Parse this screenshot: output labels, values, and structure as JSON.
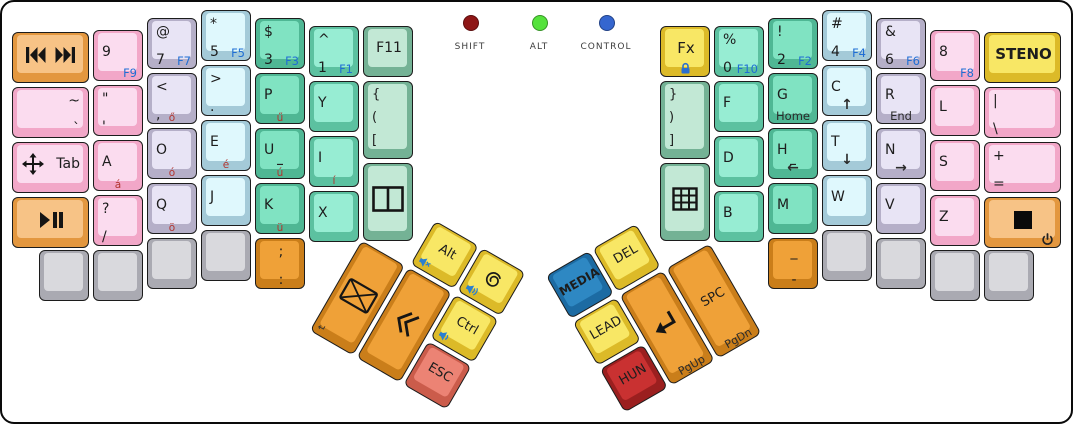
{
  "board": {
    "width": 1073,
    "height": 424
  },
  "indicators": {
    "shift": {
      "label": "SHIFT",
      "color": "#8e1616",
      "x": 468
    },
    "alt": {
      "label": "ALT",
      "color": "#55e23c",
      "x": 537
    },
    "control": {
      "label": "CONTROL",
      "color": "#3566cf",
      "x": 604
    }
  },
  "palette": {
    "fn_label": "#1f6ed4",
    "accent_label": "#b23530",
    "pink": "#fbdcef",
    "lavender": "#e8e4f5",
    "cyan": "#dff8fd",
    "teal": "#80e3c2",
    "teal_light": "#97edd3",
    "green_pale": "#c2e8d5",
    "yellow": "#f8e765",
    "orange_light": "#f7c386",
    "orange_strong": "#efa138",
    "blue": "#2e88c3",
    "red": "#c93131",
    "salmon": "#ec8374",
    "gray": "#d9d9dd"
  },
  "groups": [
    {
      "name": "left-hand",
      "x": 0,
      "y": 0,
      "rot": 0,
      "keys": [
        {
          "id": "key-media-prev-next",
          "x": 10,
          "y": 30,
          "w": 77,
          "color": "orange",
          "icons": [
            {
              "glyph": "prev",
              "name": "media-previous-icon"
            },
            {
              "glyph": "next",
              "name": "media-next-icon"
            }
          ]
        },
        {
          "id": "key-9",
          "x": 91,
          "y": 28,
          "color": "pink",
          "lines": [
            "9"
          ],
          "fn": "F9"
        },
        {
          "id": "key-7",
          "x": 145,
          "y": 16,
          "color": "lav",
          "lines": [
            "@",
            "7"
          ],
          "fn": "F7"
        },
        {
          "id": "key-5",
          "x": 199,
          "y": 8,
          "color": "cyan",
          "lines": [
            "*",
            "5"
          ],
          "fn": "F5"
        },
        {
          "id": "key-3",
          "x": 253,
          "y": 16,
          "color": "teal",
          "lines": [
            "$",
            "3"
          ],
          "fn": "F3"
        },
        {
          "id": "key-1",
          "x": 307,
          "y": 24,
          "color": "teal2",
          "lines": [
            "^",
            "1"
          ],
          "fn": "F1"
        },
        {
          "id": "key-f11",
          "x": 361,
          "y": 24,
          "color": "green",
          "lines": [
            "F11"
          ],
          "align": "center"
        },
        {
          "id": "key-tilde",
          "x": 10,
          "y": 85,
          "w": 77,
          "color": "pink",
          "lines": [
            "~",
            "`"
          ],
          "align": "right"
        },
        {
          "id": "key-quote",
          "x": 91,
          "y": 83,
          "color": "pink",
          "lines": [
            "\"",
            "'"
          ]
        },
        {
          "id": "key-comma",
          "x": 145,
          "y": 71,
          "color": "lav",
          "lines": [
            "<",
            ","
          ],
          "accent": "ő"
        },
        {
          "id": "key-period",
          "x": 199,
          "y": 63,
          "color": "cyan",
          "lines": [
            ">",
            "."
          ]
        },
        {
          "id": "key-p",
          "x": 253,
          "y": 71,
          "color": "teal",
          "lines": [
            "P"
          ],
          "accent": "ű"
        },
        {
          "id": "key-y",
          "x": 307,
          "y": 79,
          "color": "teal2",
          "lines": [
            "Y"
          ]
        },
        {
          "id": "key-brackets-open",
          "x": 361,
          "y": 79,
          "h": 78,
          "color": "green",
          "lines": [
            "{",
            "(",
            "["
          ]
        },
        {
          "id": "key-tab",
          "x": 10,
          "y": 140,
          "w": 77,
          "color": "pink",
          "lines": [
            "Tab"
          ],
          "align": "right",
          "icons": [
            {
              "glyph": "move",
              "name": "move-icon",
              "pos": "l"
            }
          ]
        },
        {
          "id": "key-a",
          "x": 91,
          "y": 138,
          "color": "pink",
          "lines": [
            "A"
          ],
          "accent": "á"
        },
        {
          "id": "key-o",
          "x": 145,
          "y": 126,
          "color": "lav",
          "lines": [
            "O"
          ],
          "accent": "ó"
        },
        {
          "id": "key-e",
          "x": 199,
          "y": 118,
          "color": "cyan",
          "lines": [
            "E"
          ],
          "accent": "é"
        },
        {
          "id": "key-u",
          "x": 253,
          "y": 126,
          "color": "teal",
          "lines": [
            "U"
          ],
          "homing": "_",
          "accent": "ú"
        },
        {
          "id": "key-i",
          "x": 307,
          "y": 134,
          "color": "teal2",
          "lines": [
            "I"
          ],
          "accent": "í"
        },
        {
          "id": "key-window-split",
          "x": 361,
          "y": 161,
          "h": 78,
          "color": "green",
          "icons": [
            {
              "glyph": "winsplit",
              "name": "window-split-icon"
            }
          ]
        },
        {
          "id": "key-play-pause",
          "x": 10,
          "y": 195,
          "w": 77,
          "color": "orange",
          "icons": [
            {
              "glyph": "playpause",
              "name": "play-pause-icon"
            }
          ]
        },
        {
          "id": "key-question",
          "x": 91,
          "y": 193,
          "color": "pink",
          "lines": [
            "?",
            "/"
          ]
        },
        {
          "id": "key-q",
          "x": 145,
          "y": 181,
          "color": "lav",
          "lines": [
            "Q"
          ],
          "accent": "ö"
        },
        {
          "id": "key-j",
          "x": 199,
          "y": 173,
          "color": "cyan",
          "lines": [
            "J"
          ]
        },
        {
          "id": "key-k",
          "x": 253,
          "y": 181,
          "color": "teal",
          "lines": [
            "K"
          ],
          "accent": "ü"
        },
        {
          "id": "key-x",
          "x": 307,
          "y": 189,
          "color": "teal2",
          "lines": [
            "X"
          ]
        },
        {
          "id": "key-blank-left-1",
          "x": 37,
          "y": 248,
          "color": "gray"
        },
        {
          "id": "key-blank-left-2",
          "x": 91,
          "y": 248,
          "color": "gray"
        },
        {
          "id": "key-blank-left-3",
          "x": 145,
          "y": 236,
          "color": "gray"
        },
        {
          "id": "key-blank-left-4",
          "x": 199,
          "y": 228,
          "color": "gray"
        },
        {
          "id": "key-semicolon",
          "x": 253,
          "y": 236,
          "color": "orange2",
          "lines": [
            ";",
            ":"
          ],
          "align": "center"
        }
      ]
    },
    {
      "name": "right-hand",
      "x": 0,
      "y": 0,
      "rot": 0,
      "keys": [
        {
          "id": "key-fx",
          "x": 658,
          "y": 24,
          "color": "yellow",
          "lines": [
            "Fx"
          ],
          "align": "center",
          "icons": [
            {
              "glyph": "lock",
              "name": "lock-icon",
              "pos": "bc"
            }
          ]
        },
        {
          "id": "key-0",
          "x": 712,
          "y": 24,
          "color": "teal2",
          "lines": [
            "%",
            "0"
          ],
          "fn": "F10"
        },
        {
          "id": "key-2",
          "x": 766,
          "y": 16,
          "color": "teal",
          "lines": [
            "!",
            "2"
          ],
          "fn": "F2"
        },
        {
          "id": "key-4",
          "x": 820,
          "y": 8,
          "color": "cyan",
          "lines": [
            "#",
            "4"
          ],
          "fn": "F4"
        },
        {
          "id": "key-6",
          "x": 874,
          "y": 16,
          "color": "lav",
          "lines": [
            "&",
            "6"
          ],
          "fn": "F6"
        },
        {
          "id": "key-8",
          "x": 928,
          "y": 28,
          "color": "pink",
          "lines": [
            "8"
          ],
          "fn": "F8"
        },
        {
          "id": "key-steno",
          "x": 982,
          "y": 30,
          "w": 77,
          "color": "yellow",
          "lines": [
            "STENO"
          ],
          "align": "center"
        },
        {
          "id": "key-brackets-close",
          "x": 658,
          "y": 79,
          "h": 78,
          "color": "green",
          "lines": [
            "}",
            ")",
            "]"
          ]
        },
        {
          "id": "key-f",
          "x": 712,
          "y": 79,
          "color": "teal2",
          "lines": [
            "F"
          ]
        },
        {
          "id": "key-g",
          "x": 766,
          "y": 71,
          "color": "teal",
          "lines": [
            "G"
          ],
          "bottom": "Home"
        },
        {
          "id": "key-c",
          "x": 820,
          "y": 63,
          "color": "cyan",
          "lines": [
            "C"
          ],
          "bottom": "↑"
        },
        {
          "id": "key-r",
          "x": 874,
          "y": 71,
          "color": "lav",
          "lines": [
            "R"
          ],
          "bottom": "End"
        },
        {
          "id": "key-l",
          "x": 928,
          "y": 83,
          "color": "pink",
          "lines": [
            "L"
          ]
        },
        {
          "id": "key-pipe",
          "x": 982,
          "y": 85,
          "w": 77,
          "color": "pink",
          "lines": [
            "|",
            "\\"
          ]
        },
        {
          "id": "key-grid",
          "x": 658,
          "y": 161,
          "h": 78,
          "color": "green",
          "icons": [
            {
              "glyph": "grid",
              "name": "grid-icon"
            }
          ]
        },
        {
          "id": "key-d",
          "x": 712,
          "y": 134,
          "color": "teal2",
          "lines": [
            "D"
          ]
        },
        {
          "id": "key-h",
          "x": 766,
          "y": 126,
          "color": "teal",
          "lines": [
            "H"
          ],
          "homing": "_",
          "bottom": "←"
        },
        {
          "id": "key-t",
          "x": 820,
          "y": 118,
          "color": "cyan",
          "lines": [
            "T"
          ],
          "bottom": "↓"
        },
        {
          "id": "key-n",
          "x": 874,
          "y": 126,
          "color": "lav",
          "lines": [
            "N"
          ],
          "bottom": "→"
        },
        {
          "id": "key-s",
          "x": 928,
          "y": 138,
          "color": "pink",
          "lines": [
            "S"
          ]
        },
        {
          "id": "key-plus",
          "x": 982,
          "y": 140,
          "w": 77,
          "color": "pink",
          "lines": [
            "+",
            "="
          ]
        },
        {
          "id": "key-b",
          "x": 712,
          "y": 189,
          "color": "teal2",
          "lines": [
            "B"
          ]
        },
        {
          "id": "key-m",
          "x": 766,
          "y": 181,
          "color": "teal",
          "lines": [
            "M"
          ]
        },
        {
          "id": "key-w",
          "x": 820,
          "y": 173,
          "color": "cyan",
          "lines": [
            "W"
          ]
        },
        {
          "id": "key-v",
          "x": 874,
          "y": 181,
          "color": "lav",
          "lines": [
            "V"
          ]
        },
        {
          "id": "key-z",
          "x": 928,
          "y": 193,
          "color": "pink",
          "lines": [
            "Z"
          ]
        },
        {
          "id": "key-stop-power",
          "x": 982,
          "y": 195,
          "w": 77,
          "color": "orange",
          "icons": [
            {
              "glyph": "stop",
              "name": "stop-icon"
            },
            {
              "glyph": "power",
              "name": "power-icon",
              "pos": "br"
            }
          ]
        },
        {
          "id": "key-minus",
          "x": 766,
          "y": 236,
          "color": "orange2",
          "lines": [
            "_",
            "-"
          ],
          "align": "center"
        },
        {
          "id": "key-blank-right-1",
          "x": 820,
          "y": 228,
          "color": "gray"
        },
        {
          "id": "key-blank-right-2",
          "x": 874,
          "y": 236,
          "color": "gray"
        },
        {
          "id": "key-blank-right-3",
          "x": 928,
          "y": 248,
          "color": "gray"
        },
        {
          "id": "key-blank-right-4",
          "x": 982,
          "y": 248,
          "color": "gray"
        }
      ]
    },
    {
      "name": "left-thumb-cluster",
      "x": 386,
      "y": 189,
      "rot": 30,
      "keys": [
        {
          "id": "key-alt",
          "x": 56,
          "y": 2,
          "h": 50,
          "color": "yellow",
          "lines": [
            "Alt"
          ],
          "align": "center",
          "icons": [
            {
              "glyph": "volmute",
              "name": "volume-mute-icon",
              "pos": "bl"
            }
          ]
        },
        {
          "id": "key-debian",
          "x": 110,
          "y": 2,
          "h": 50,
          "color": "yellow",
          "icons": [
            {
              "glyph": "debian",
              "name": "debian-swirl-icon"
            },
            {
              "glyph": "volup",
              "name": "volume-up-icon",
              "pos": "bl"
            }
          ]
        },
        {
          "id": "key-mail",
          "x": 2,
          "y": 56,
          "h": 104,
          "color": "orange2",
          "corner": "↵",
          "icons": [
            {
              "glyph": "mail",
              "name": "mail-icon"
            }
          ]
        },
        {
          "id": "key-chevrons",
          "x": 56,
          "y": 56,
          "h": 104,
          "color": "orange2",
          "icons": [
            {
              "glyph": "chevleft",
              "name": "double-chevron-left-icon"
            }
          ]
        },
        {
          "id": "key-ctrl",
          "x": 110,
          "y": 56,
          "h": 50,
          "color": "yellow",
          "lines": [
            "Ctrl"
          ],
          "align": "center",
          "icons": [
            {
              "glyph": "voldown",
              "name": "volume-down-icon",
              "pos": "bl"
            }
          ]
        },
        {
          "id": "key-esc",
          "x": 110,
          "y": 110,
          "h": 50,
          "color": "salmon",
          "lines": [
            "ESC"
          ],
          "align": "center"
        }
      ]
    },
    {
      "name": "right-thumb-cluster",
      "x": 541,
      "y": 273,
      "rot": -30,
      "keys": [
        {
          "id": "key-media",
          "x": 2,
          "y": 2,
          "h": 50,
          "color": "blue",
          "lines": [
            "MEDIA"
          ],
          "align": "center"
        },
        {
          "id": "key-del",
          "x": 56,
          "y": 2,
          "h": 50,
          "color": "yellow",
          "lines": [
            "DEL"
          ],
          "align": "center"
        },
        {
          "id": "key-lead",
          "x": 2,
          "y": 56,
          "h": 50,
          "color": "yellow",
          "lines": [
            "LEAD"
          ],
          "align": "center"
        },
        {
          "id": "key-hun",
          "x": 2,
          "y": 110,
          "h": 50,
          "color": "red",
          "lines": [
            "HUN"
          ],
          "align": "center"
        },
        {
          "id": "key-enter",
          "x": 56,
          "y": 56,
          "h": 104,
          "color": "orange2",
          "bottom": "PgUp",
          "icons": [
            {
              "glyph": "return",
              "name": "return-arrow-icon"
            }
          ]
        },
        {
          "id": "key-spc",
          "x": 110,
          "y": 56,
          "h": 104,
          "color": "orange2",
          "lines": [
            "SPC"
          ],
          "align": "center",
          "bottom": "PgDn"
        }
      ]
    }
  ]
}
